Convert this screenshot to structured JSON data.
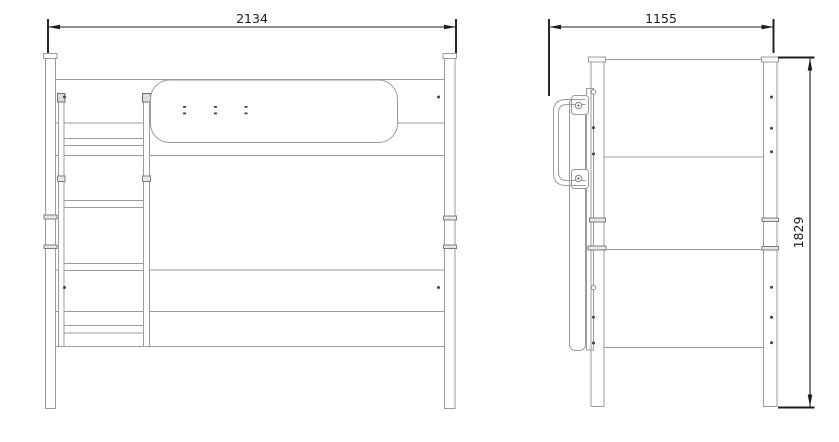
{
  "title": "Bunk bed technical drawing — front and side elevation",
  "dimensions": {
    "front_width": "2134",
    "side_depth": "1155",
    "height": "1829"
  },
  "views": {
    "front": {
      "label": "front-elevation",
      "parts": [
        "left-post",
        "right-post",
        "ladder",
        "guard-rail-panel",
        "bed-rails"
      ]
    },
    "side": {
      "label": "side-elevation",
      "parts": [
        "left-post",
        "right-post",
        "grab-handle",
        "ladder-profile",
        "panel-rails"
      ]
    }
  },
  "colors": {
    "background": "#ffffff",
    "drawing_line": "#9b9b9b",
    "dimension_line": "#1c1c1c",
    "fitting_dark": "#6f6f6f"
  }
}
